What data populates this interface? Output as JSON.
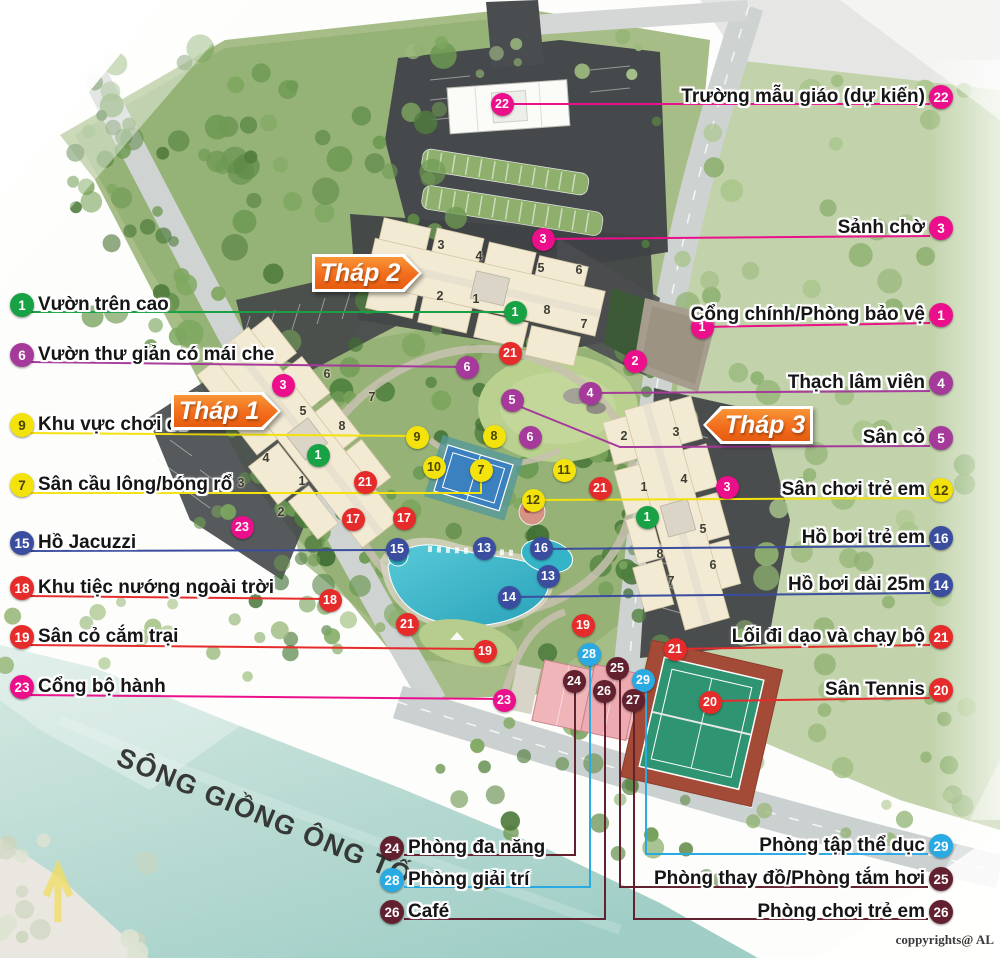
{
  "copyright": "coppyrights@ AL",
  "river": {
    "name": "SÔNG GIỒNG ÔNG TỐ"
  },
  "colors": {
    "green": "#18a145",
    "pink": "#ec0f8c",
    "purple": "#a53a9b",
    "yellow": "#f3e20c",
    "red": "#e62b2b",
    "blue": "#3a4d9f",
    "cyan": "#29aae3",
    "maroon": "#63202f",
    "orange": "#f26d1d"
  },
  "tower_signs": [
    {
      "label": "Tháp 2",
      "x": 312,
      "y": 254,
      "w": 110,
      "h": 38,
      "dir": "right"
    },
    {
      "label": "Tháp 1",
      "x": 171,
      "y": 392,
      "w": 110,
      "h": 38,
      "dir": "right"
    },
    {
      "label": "Tháp 3",
      "x": 703,
      "y": 406,
      "w": 110,
      "h": 38,
      "dir": "left"
    }
  ],
  "legend": {
    "left": {
      "align": "left",
      "items": [
        {
          "num": "1",
          "color": "green",
          "x": 22,
          "y": 305,
          "text": "Vườn trên cao",
          "line": [
            [
              28,
              312
            ],
            [
              515,
              312
            ]
          ]
        },
        {
          "num": "6",
          "color": "purple",
          "x": 22,
          "y": 355,
          "text": "Vườn thư giản có mái che",
          "line": [
            [
              28,
              362
            ],
            [
              467,
              367
            ]
          ]
        },
        {
          "num": "9",
          "color": "yellow",
          "x": 22,
          "y": 425,
          "text": "Khu vực chơi cờ",
          "line": [
            [
              28,
              433
            ],
            [
              417,
              436
            ]
          ]
        },
        {
          "num": "7",
          "color": "yellow",
          "x": 22,
          "y": 485,
          "text": "Sân cầu lông/bóng rổ",
          "line": [
            [
              28,
              493
            ],
            [
              481,
              493
            ],
            [
              481,
              477
            ]
          ]
        },
        {
          "num": "15",
          "color": "blue",
          "x": 22,
          "y": 543,
          "text": "Hồ Jacuzzi",
          "line": [
            [
              28,
              551
            ],
            [
              397,
              550
            ]
          ]
        },
        {
          "num": "18",
          "color": "red",
          "x": 22,
          "y": 588,
          "text": "Khu tiệc nướng ngoài trời",
          "line": [
            [
              28,
              596
            ],
            [
              330,
              599
            ]
          ]
        },
        {
          "num": "19",
          "color": "red",
          "x": 22,
          "y": 637,
          "text": "Sân cỏ cắm trại",
          "line": [
            [
              28,
              645
            ],
            [
              485,
              649
            ]
          ]
        },
        {
          "num": "23",
          "color": "pink",
          "x": 22,
          "y": 687,
          "text": "Cổng bộ hành",
          "line": [
            [
              28,
              695
            ],
            [
              504,
              699
            ]
          ]
        }
      ]
    },
    "right": {
      "align": "right",
      "items": [
        {
          "num": "22",
          "color": "pink",
          "x": 941,
          "y": 97,
          "text": "Trường mẫu giáo (dự kiến)",
          "line": [
            [
              930,
              104
            ],
            [
              502,
              104
            ]
          ]
        },
        {
          "num": "3",
          "color": "pink",
          "x": 941,
          "y": 228,
          "text": "Sảnh chờ",
          "line": [
            [
              930,
              236
            ],
            [
              543,
              239
            ]
          ]
        },
        {
          "num": "1",
          "color": "pink",
          "x": 941,
          "y": 315,
          "text": "Cổng chính/Phòng bảo vệ",
          "line": [
            [
              930,
              323
            ],
            [
              702,
              327
            ]
          ]
        },
        {
          "num": "4",
          "color": "purple",
          "x": 941,
          "y": 383,
          "text": "Thạch lâm viên",
          "line": [
            [
              930,
              391
            ],
            [
              590,
              393
            ]
          ]
        },
        {
          "num": "5",
          "color": "purple",
          "x": 941,
          "y": 438,
          "text": "Sân cỏ",
          "line": [
            [
              930,
              446
            ],
            [
              620,
              447
            ],
            [
              516,
              405
            ]
          ]
        },
        {
          "num": "12",
          "color": "yellow",
          "x": 941,
          "y": 490,
          "text": "Sân chơi trẻ em",
          "line": [
            [
              930,
              498
            ],
            [
              533,
              500
            ]
          ]
        },
        {
          "num": "16",
          "color": "blue",
          "x": 941,
          "y": 538,
          "text": "Hồ bơi trẻ em",
          "line": [
            [
              930,
              546
            ],
            [
              541,
              549
            ]
          ]
        },
        {
          "num": "14",
          "color": "blue",
          "x": 941,
          "y": 585,
          "text": "Hồ bơi dài 25m",
          "line": [
            [
              930,
              593
            ],
            [
              509,
              597
            ]
          ]
        },
        {
          "num": "21",
          "color": "red",
          "x": 941,
          "y": 637,
          "text": "Lối đi dạo và chạy bộ",
          "line": [
            [
              930,
              645
            ],
            [
              675,
              649
            ]
          ]
        },
        {
          "num": "20",
          "color": "red",
          "x": 941,
          "y": 690,
          "text": "Sân Tennis",
          "line": [
            [
              930,
              698
            ],
            [
              712,
              701
            ]
          ]
        }
      ]
    },
    "bottom_left": {
      "align": "left",
      "items": [
        {
          "num": "24",
          "color": "maroon",
          "x": 392,
          "y": 848,
          "text": "Phòng đa năng",
          "line": [
            [
              404,
              855
            ],
            [
              575,
              855
            ],
            [
              575,
              688
            ]
          ]
        },
        {
          "num": "28",
          "color": "cyan",
          "x": 392,
          "y": 880,
          "text": "Phòng giải trí",
          "line": [
            [
              404,
              887
            ],
            [
              590,
              887
            ],
            [
              590,
              661
            ]
          ]
        },
        {
          "num": "26",
          "color": "maroon",
          "x": 392,
          "y": 912,
          "text": "Café",
          "line": [
            [
              404,
              919
            ],
            [
              605,
              919
            ],
            [
              605,
              698
            ]
          ]
        }
      ]
    },
    "bottom_right": {
      "align": "right",
      "items": [
        {
          "num": "29",
          "color": "cyan",
          "x": 941,
          "y": 846,
          "text": "Phòng tập thể dục",
          "line": [
            [
              928,
              854
            ],
            [
              646,
              854
            ],
            [
              646,
              687
            ]
          ]
        },
        {
          "num": "25",
          "color": "maroon",
          "x": 941,
          "y": 879,
          "text": "Phòng thay đồ/Phòng tắm hơi",
          "line": [
            [
              928,
              887
            ],
            [
              620,
              887
            ],
            [
              620,
              675
            ]
          ]
        },
        {
          "num": "26",
          "color": "maroon",
          "x": 941,
          "y": 912,
          "text": "Phòng chơi trẻ em",
          "line": [
            [
              928,
              919
            ],
            [
              634,
              919
            ],
            [
              634,
              707
            ]
          ]
        }
      ]
    }
  },
  "map_markers": [
    {
      "num": "1",
      "color": "green",
      "x": 515,
      "y": 312
    },
    {
      "num": "1",
      "color": "green",
      "x": 318,
      "y": 455
    },
    {
      "num": "1",
      "color": "green",
      "x": 647,
      "y": 517
    },
    {
      "num": "22",
      "color": "pink",
      "x": 502,
      "y": 104
    },
    {
      "num": "3",
      "color": "pink",
      "x": 543,
      "y": 239
    },
    {
      "num": "2",
      "color": "pink",
      "x": 635,
      "y": 361
    },
    {
      "num": "1",
      "color": "pink",
      "x": 702,
      "y": 327
    },
    {
      "num": "3",
      "color": "pink",
      "x": 283,
      "y": 385
    },
    {
      "num": "3",
      "color": "pink",
      "x": 727,
      "y": 487
    },
    {
      "num": "23",
      "color": "pink",
      "x": 242,
      "y": 527
    },
    {
      "num": "23",
      "color": "pink",
      "x": 504,
      "y": 700
    },
    {
      "num": "6",
      "color": "purple",
      "x": 467,
      "y": 367
    },
    {
      "num": "4",
      "color": "purple",
      "x": 590,
      "y": 393
    },
    {
      "num": "5",
      "color": "purple",
      "x": 512,
      "y": 400
    },
    {
      "num": "6",
      "color": "purple",
      "x": 530,
      "y": 437
    },
    {
      "num": "9",
      "color": "yellow",
      "x": 417,
      "y": 437
    },
    {
      "num": "8",
      "color": "yellow",
      "x": 494,
      "y": 436
    },
    {
      "num": "10",
      "color": "yellow",
      "x": 434,
      "y": 467
    },
    {
      "num": "7",
      "color": "yellow",
      "x": 481,
      "y": 470
    },
    {
      "num": "11",
      "color": "yellow",
      "x": 564,
      "y": 470
    },
    {
      "num": "12",
      "color": "yellow",
      "x": 533,
      "y": 500
    },
    {
      "num": "21",
      "color": "red",
      "x": 510,
      "y": 353
    },
    {
      "num": "21",
      "color": "red",
      "x": 365,
      "y": 482
    },
    {
      "num": "21",
      "color": "red",
      "x": 600,
      "y": 488
    },
    {
      "num": "17",
      "color": "red",
      "x": 353,
      "y": 519
    },
    {
      "num": "17",
      "color": "red",
      "x": 404,
      "y": 518
    },
    {
      "num": "18",
      "color": "red",
      "x": 330,
      "y": 600
    },
    {
      "num": "21",
      "color": "red",
      "x": 407,
      "y": 624
    },
    {
      "num": "19",
      "color": "red",
      "x": 583,
      "y": 625
    },
    {
      "num": "19",
      "color": "red",
      "x": 485,
      "y": 651
    },
    {
      "num": "21",
      "color": "red",
      "x": 675,
      "y": 649
    },
    {
      "num": "20",
      "color": "red",
      "x": 710,
      "y": 702
    },
    {
      "num": "15",
      "color": "blue",
      "x": 397,
      "y": 549
    },
    {
      "num": "13",
      "color": "blue",
      "x": 484,
      "y": 548
    },
    {
      "num": "16",
      "color": "blue",
      "x": 541,
      "y": 548
    },
    {
      "num": "13",
      "color": "blue",
      "x": 548,
      "y": 576
    },
    {
      "num": "14",
      "color": "blue",
      "x": 509,
      "y": 597
    },
    {
      "num": "28",
      "color": "cyan",
      "x": 589,
      "y": 654
    },
    {
      "num": "29",
      "color": "cyan",
      "x": 643,
      "y": 680
    },
    {
      "num": "24",
      "color": "maroon",
      "x": 574,
      "y": 681
    },
    {
      "num": "25",
      "color": "maroon",
      "x": 617,
      "y": 668
    },
    {
      "num": "26",
      "color": "maroon",
      "x": 604,
      "y": 691
    },
    {
      "num": "27",
      "color": "maroon",
      "x": 633,
      "y": 700
    }
  ],
  "unit_numbers": [
    {
      "n": "3",
      "x": 441,
      "y": 246
    },
    {
      "n": "4",
      "x": 479,
      "y": 257
    },
    {
      "n": "5",
      "x": 541,
      "y": 269
    },
    {
      "n": "6",
      "x": 579,
      "y": 271
    },
    {
      "n": "2",
      "x": 440,
      "y": 297
    },
    {
      "n": "1",
      "x": 476,
      "y": 300
    },
    {
      "n": "8",
      "x": 547,
      "y": 311
    },
    {
      "n": "7",
      "x": 584,
      "y": 325
    },
    {
      "n": "6",
      "x": 327,
      "y": 375
    },
    {
      "n": "7",
      "x": 372,
      "y": 398
    },
    {
      "n": "5",
      "x": 303,
      "y": 412
    },
    {
      "n": "8",
      "x": 342,
      "y": 427
    },
    {
      "n": "4",
      "x": 266,
      "y": 459
    },
    {
      "n": "3",
      "x": 241,
      "y": 484
    },
    {
      "n": "1",
      "x": 302,
      "y": 482
    },
    {
      "n": "2",
      "x": 281,
      "y": 513
    },
    {
      "n": "2",
      "x": 624,
      "y": 437
    },
    {
      "n": "3",
      "x": 676,
      "y": 433
    },
    {
      "n": "4",
      "x": 684,
      "y": 480
    },
    {
      "n": "1",
      "x": 644,
      "y": 488
    },
    {
      "n": "5",
      "x": 703,
      "y": 530
    },
    {
      "n": "8",
      "x": 660,
      "y": 555
    },
    {
      "n": "6",
      "x": 713,
      "y": 566
    },
    {
      "n": "7",
      "x": 671,
      "y": 582
    }
  ]
}
